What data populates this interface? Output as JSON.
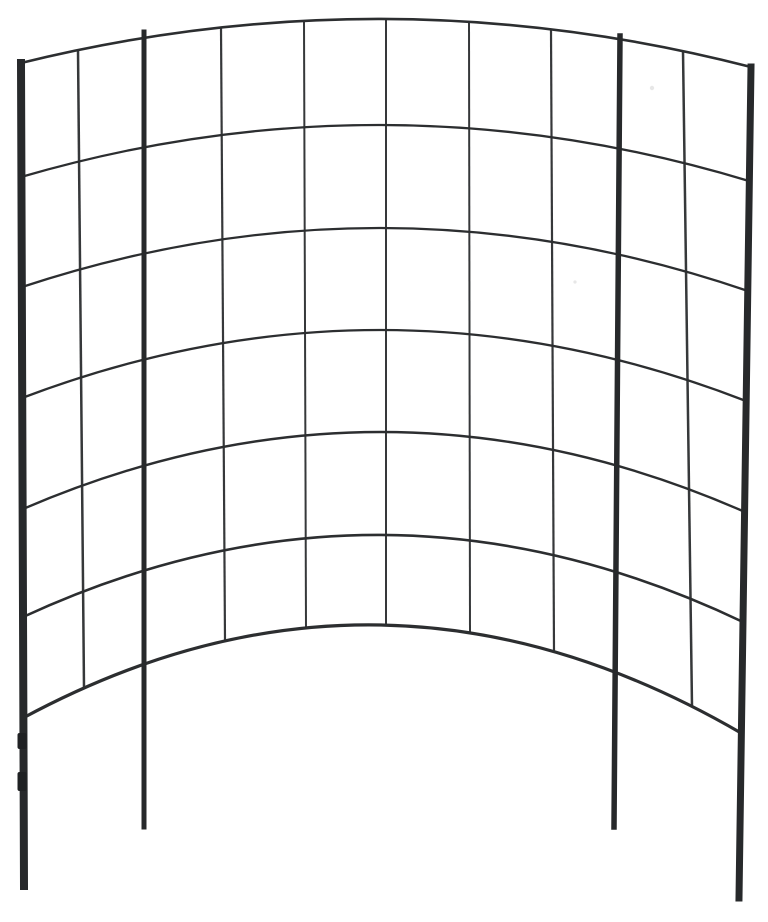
{
  "image": {
    "subject": "curved-metal-grid-garden-trellis",
    "background_color": "#ffffff",
    "canvas": {
      "width": 768,
      "height": 922
    },
    "colors": {
      "post": "#27292b",
      "thin_wire": "#36383a",
      "horizontal_wire": "#2c2e30",
      "clip": "#1f2123",
      "speck": "#e7e7e7"
    },
    "posts": [
      {
        "name": "outer-left-post",
        "x_top": 21,
        "y_top": 63,
        "x_bottom": 24,
        "y_bottom": 886,
        "width": 8
      },
      {
        "name": "inner-left-post",
        "x_top": 144,
        "y_top": 32,
        "x_bottom": 144,
        "y_bottom": 827,
        "width": 5
      },
      {
        "name": "inner-right-post",
        "x_top": 620,
        "y_top": 36,
        "x_bottom": 614,
        "y_bottom": 827,
        "width": 5.5
      },
      {
        "name": "outer-right-post",
        "x_top": 751,
        "y_top": 67,
        "x_bottom": 739,
        "y_bottom": 898,
        "width": 7
      }
    ],
    "rows": [
      {
        "x_left": 21,
        "y_left": 63,
        "y_apex": 19,
        "x_right": 751,
        "y_right": 67,
        "width": 2.6
      },
      {
        "x_left": 21,
        "y_left": 177,
        "y_apex": 125,
        "x_right": 749,
        "y_right": 181,
        "width": 2.3
      },
      {
        "x_left": 22,
        "y_left": 287,
        "y_apex": 228,
        "x_right": 748,
        "y_right": 291,
        "width": 2.3
      },
      {
        "x_left": 22,
        "y_left": 398,
        "y_apex": 330,
        "x_right": 746,
        "y_right": 401,
        "width": 2.3
      },
      {
        "x_left": 23,
        "y_left": 509,
        "y_apex": 432,
        "x_right": 745,
        "y_right": 512,
        "width": 2.4
      },
      {
        "x_left": 23,
        "y_left": 617,
        "y_apex": 535,
        "x_right": 743,
        "y_right": 622,
        "width": 2.6
      },
      {
        "x_left": 23,
        "y_left": 718,
        "y_apex": 625,
        "x_right": 741,
        "y_right": 733,
        "width": 3.2
      }
    ],
    "thin_columns": [
      {
        "x_top": 78,
        "x_bottom": 84,
        "width": 2.5
      },
      {
        "x_top": 221,
        "x_bottom": 225,
        "width": 2.2
      },
      {
        "x_top": 304,
        "x_bottom": 306,
        "width": 2.0
      },
      {
        "x_top": 386,
        "x_bottom": 386,
        "width": 2.0
      },
      {
        "x_top": 469,
        "x_bottom": 470,
        "width": 2.0
      },
      {
        "x_top": 551,
        "x_bottom": 554,
        "width": 2.2
      },
      {
        "x_top": 683,
        "x_bottom": 692,
        "width": 2.5
      }
    ],
    "clips": [
      {
        "x": 17.5,
        "y": 733,
        "w": 9,
        "h": 16
      },
      {
        "x": 17.5,
        "y": 772,
        "w": 9,
        "h": 19
      }
    ],
    "specks": [
      {
        "cx": 652,
        "cy": 88,
        "r": 2.2
      },
      {
        "cx": 575,
        "cy": 282,
        "r": 1.6
      }
    ]
  }
}
